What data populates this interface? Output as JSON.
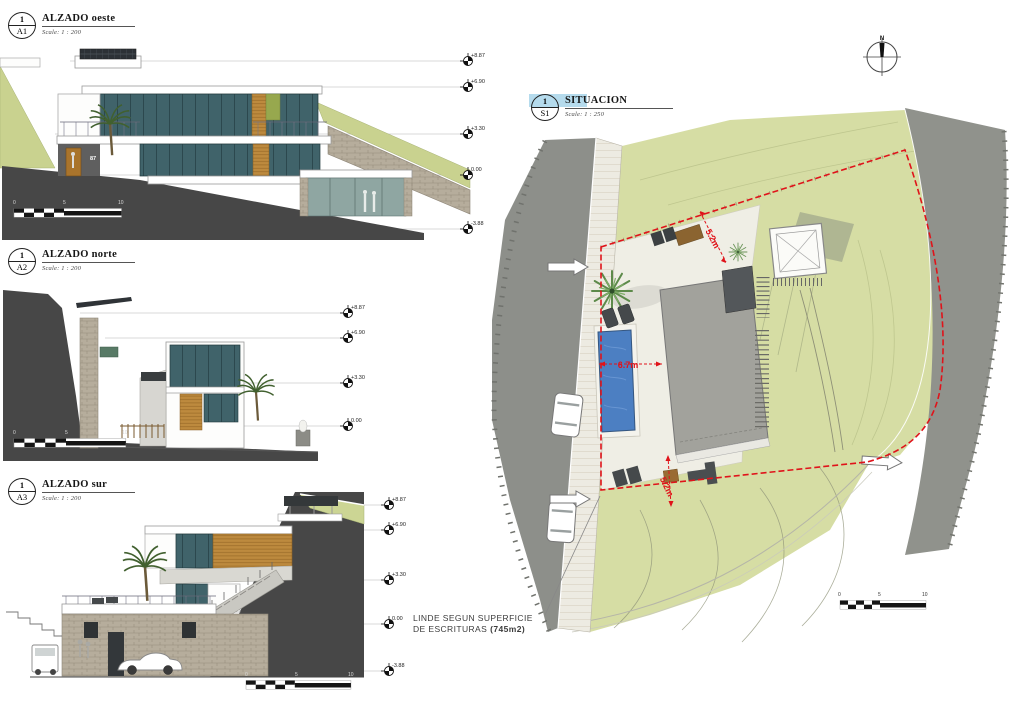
{
  "sheet": {
    "background": "#ffffff"
  },
  "views": {
    "oeste": {
      "num": "1",
      "code": "A1",
      "title": "ALZADO oeste",
      "scale": "Scale: 1 : 200",
      "house_number": "87",
      "levels": [
        "+8.87",
        "+6.90",
        "+3.30",
        "0.00",
        "-3.88"
      ]
    },
    "norte": {
      "num": "1",
      "code": "A2",
      "title": "ALZADO norte",
      "scale": "Scale: 1 : 200",
      "levels": [
        "+8.87",
        "+6.90",
        "+3.30",
        "0.00"
      ]
    },
    "sur": {
      "num": "1",
      "code": "A3",
      "title": "ALZADO sur",
      "scale": "Scale: 1 : 200",
      "levels": [
        "+8.87",
        "+6.90",
        "+3.30",
        "0.00",
        "-3.88"
      ]
    },
    "situacion": {
      "num": "1",
      "code": "S1",
      "title": "SITUACION",
      "scale": "Scale: 1 : 250",
      "north_label": "N",
      "dimensions": {
        "top": "5.2m",
        "middle": "6.7m",
        "bottom": "5.2m"
      }
    }
  },
  "annotation": {
    "line1": "LINDE SEGUN SUPERFICIE",
    "line2": "DE ESCRITURAS",
    "line2_bold": "(745m2)"
  },
  "scalebar": {
    "zero": "0",
    "five": "5",
    "ten": "10"
  },
  "colors": {
    "boundary_red": "#e0131a",
    "pool_blue": "#4c7fc2",
    "terrain_dark": "#474747",
    "grass_green": "#ccd491",
    "road_gray": "#8d8f8a"
  }
}
